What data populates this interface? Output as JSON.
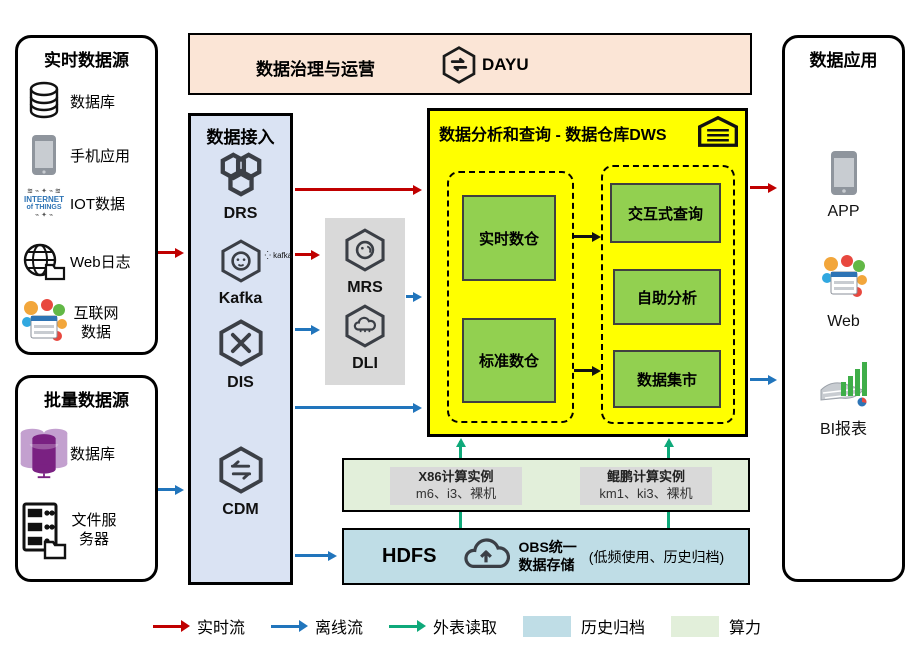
{
  "realtime": {
    "title": "实时数据源",
    "items": [
      "数据库",
      "手机应用",
      "IOT数据",
      "Web日志",
      "互联网数据"
    ]
  },
  "batch": {
    "title": "批量数据源",
    "items": [
      "数据库",
      "文件服务器"
    ]
  },
  "governance": {
    "title": "数据治理与运营",
    "product": "DAYU"
  },
  "access": {
    "title": "数据接入",
    "services": [
      "DRS",
      "Kafka",
      "DIS",
      "CDM"
    ],
    "kafka_badge": "kafka"
  },
  "processing": {
    "services": [
      "MRS",
      "DLI"
    ]
  },
  "dws": {
    "title": "数据分析和查询 - 数据仓库DWS",
    "left": [
      "实时数仓",
      "标准数仓"
    ],
    "right": [
      "交互式查询",
      "自助分析",
      "数据集市"
    ]
  },
  "compute": {
    "x86_title": "X86计算实例",
    "x86_sub": "m6、i3、裸机",
    "kunpeng_title": "鲲鹏计算实例",
    "kunpeng_sub": "km1、ki3、裸机"
  },
  "storage": {
    "hdfs": "HDFS",
    "obs_line1": "OBS统一",
    "obs_line2": "数据存储",
    "note": "(低频使用、历史归档)"
  },
  "apps": {
    "title": "数据应用",
    "items": [
      "APP",
      "Web",
      "BI报表"
    ]
  },
  "iot_icon": {
    "line1": "INTERNET",
    "line2": "of THINGS"
  },
  "legend": {
    "items": [
      "实时流",
      "离线流",
      "外表读取",
      "历史归档",
      "算力"
    ]
  },
  "colors": {
    "realtime_flow": "#c00000",
    "offline_flow": "#2175bc",
    "external_read": "#0fa97a",
    "archive_fill": "#bfdde6",
    "compute_fill": "#e2efda",
    "warehouse_bg": "#ffff00",
    "warehouse_box": "#92d050",
    "access_bg": "#dae3f3",
    "governance_bg": "#fbe5d6",
    "gray_fill": "#d9d9d9"
  }
}
